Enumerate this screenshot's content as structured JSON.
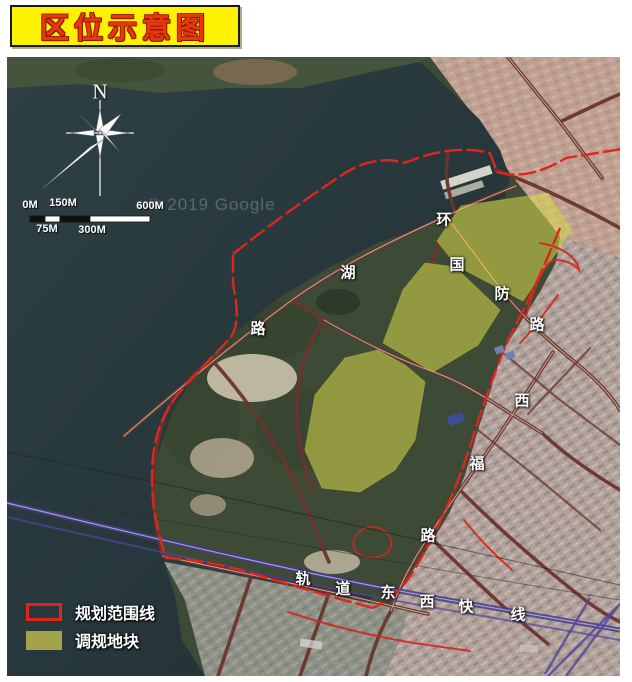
{
  "title": {
    "text": "区位示意图"
  },
  "map": {
    "north_label": "N",
    "watermark": "© 2019 Google",
    "scale_bar": {
      "top_labels": [
        {
          "text": "0M",
          "x": 30,
          "y": 205
        },
        {
          "text": "150M",
          "x": 63,
          "y": 203
        },
        {
          "text": "600M",
          "x": 150,
          "y": 206
        }
      ],
      "bottom_labels": [
        {
          "text": "75M",
          "x": 47,
          "y": 229
        },
        {
          "text": "300M",
          "x": 92,
          "y": 230
        }
      ]
    },
    "roads": [
      {
        "name": "环湖路",
        "chars": [
          {
            "ch": "环",
            "x": 444,
            "y": 219
          },
          {
            "ch": "湖",
            "x": 348,
            "y": 272
          },
          {
            "ch": "路",
            "x": 258,
            "y": 328
          }
        ]
      },
      {
        "name": "国防路",
        "chars": [
          {
            "ch": "国",
            "x": 457,
            "y": 264
          },
          {
            "ch": "防",
            "x": 502,
            "y": 293
          },
          {
            "ch": "路",
            "x": 537,
            "y": 324
          }
        ]
      },
      {
        "name": "西福路",
        "chars": [
          {
            "ch": "西",
            "x": 522,
            "y": 400
          },
          {
            "ch": "福",
            "x": 477,
            "y": 463
          },
          {
            "ch": "路",
            "x": 428,
            "y": 535
          }
        ]
      },
      {
        "name": "轨道东西快线",
        "chars": [
          {
            "ch": "轨",
            "x": 303,
            "y": 578
          },
          {
            "ch": "道",
            "x": 343,
            "y": 588
          },
          {
            "ch": "东",
            "x": 388,
            "y": 592
          },
          {
            "ch": "西",
            "x": 427,
            "y": 601
          },
          {
            "ch": "快",
            "x": 466,
            "y": 606
          },
          {
            "ch": "线",
            "x": 518,
            "y": 614
          }
        ]
      }
    ],
    "legend": {
      "items": [
        {
          "label": "规划范围线",
          "swatch": "outline"
        },
        {
          "label": "调规地块",
          "swatch": "fill"
        }
      ]
    }
  },
  "colors": {
    "title_bg": "#fff200",
    "title_text": "#e8380d",
    "title_border": "#1a1a1a",
    "boundary_red": "#e0251c",
    "plot_yellow": "#d8da4a",
    "legend_olive": "#a2a24b",
    "road_maroon": "#6b352d",
    "rail_purple": "#4f4496",
    "water_dark": "#27373b",
    "label_white": "#ffffff"
  }
}
